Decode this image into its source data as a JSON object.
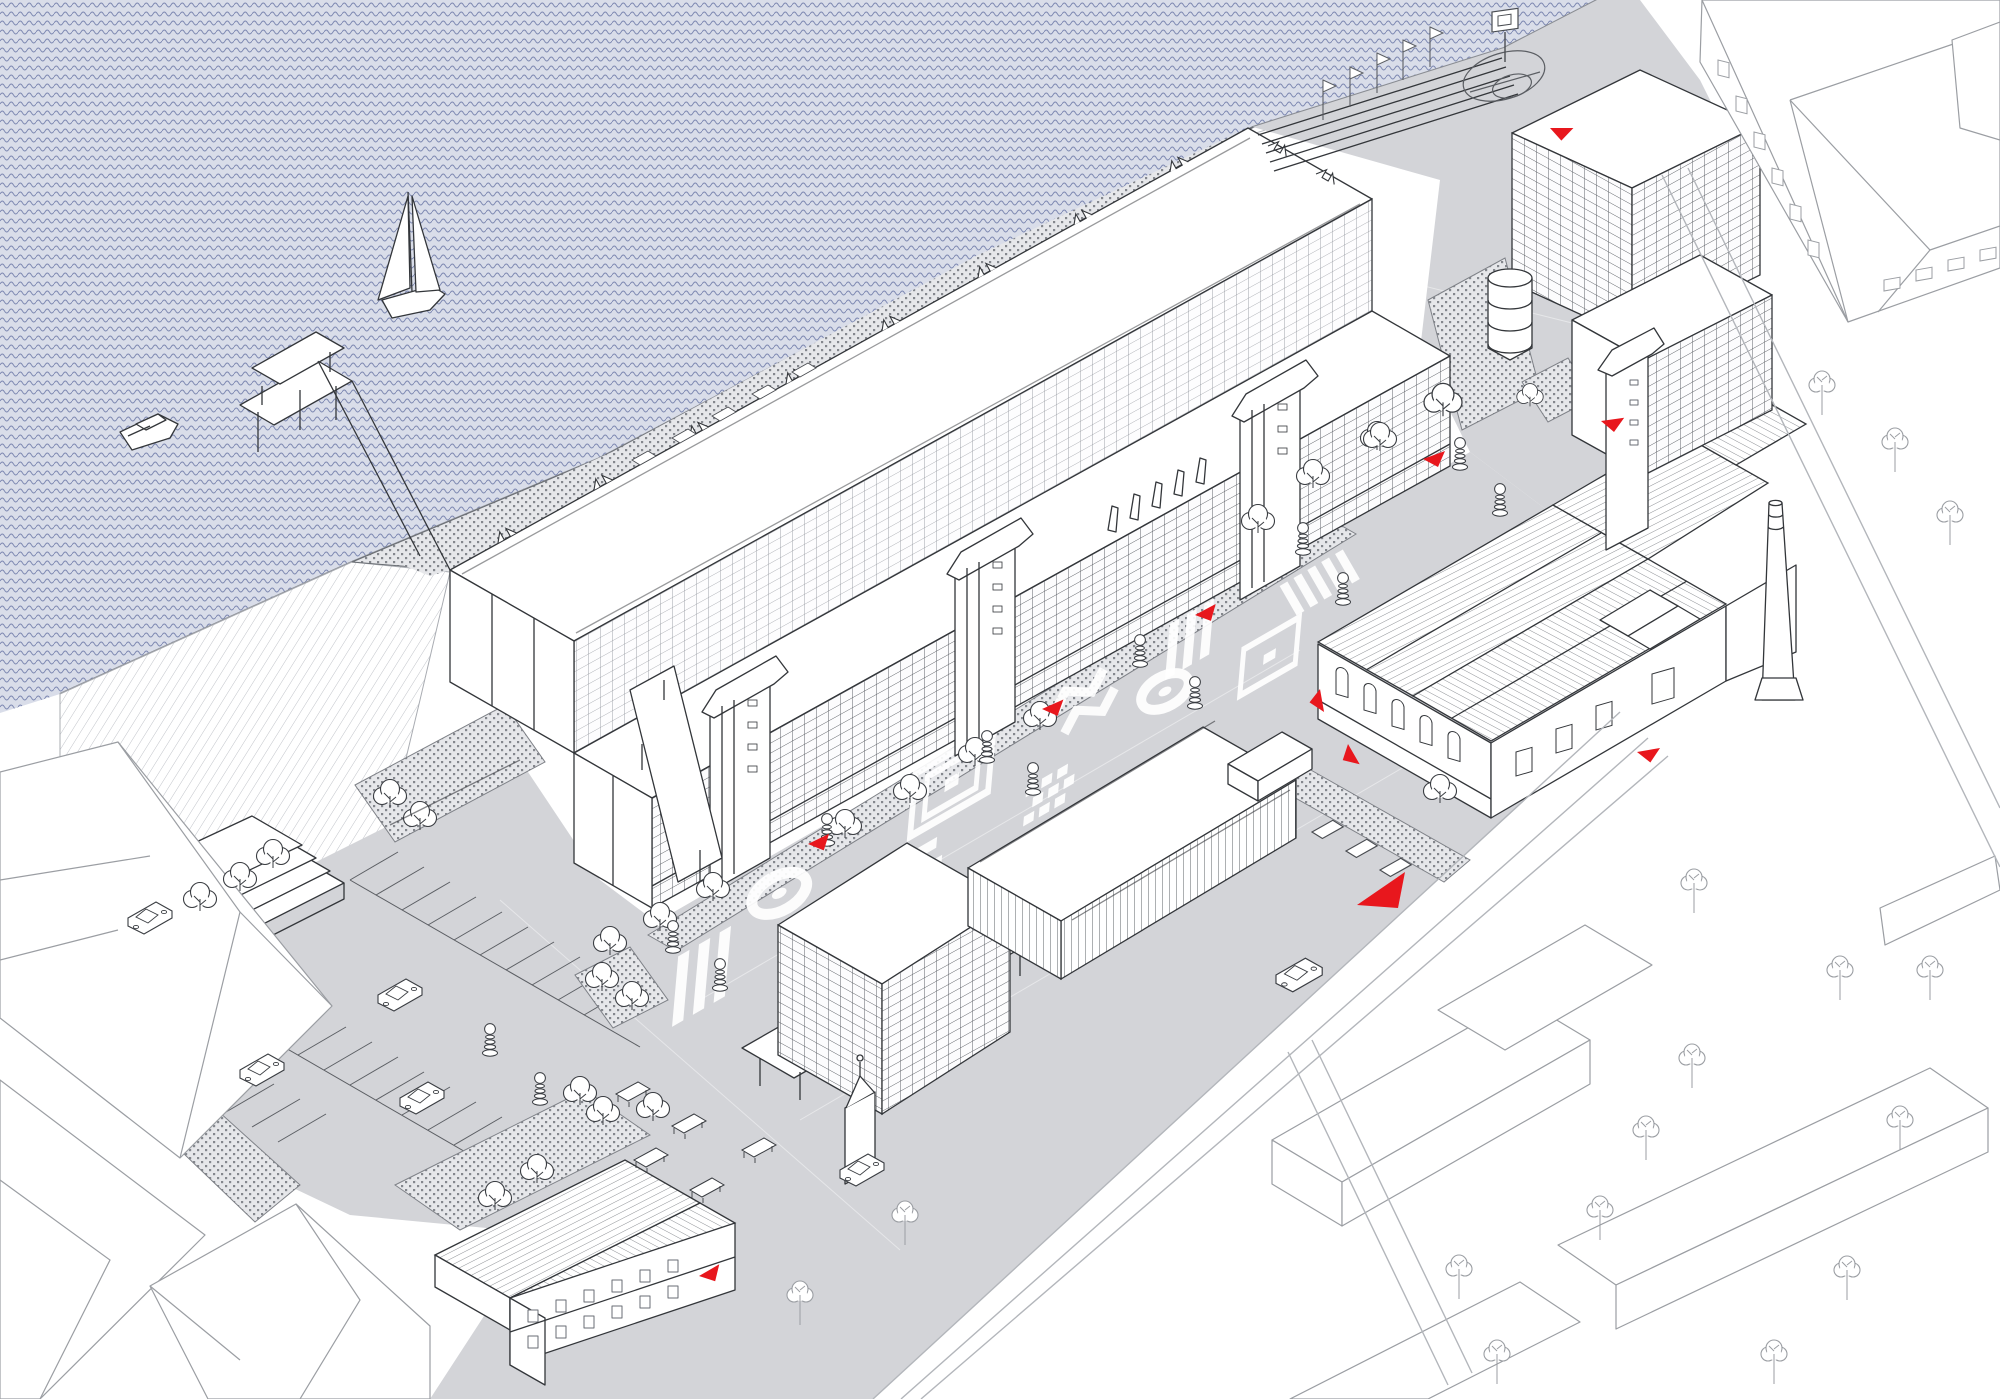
{
  "meta": {
    "title": "Axonometric masterplan drawing of a waterfront factory campus",
    "drawing_type": "architectural site axonometric, line drawing with red accents",
    "image_size": {
      "width": 2000,
      "height": 1399
    }
  },
  "palette": {
    "paper": "#ffffff",
    "water_base": "#d9dde9",
    "water_wave_line": "#7e89b2",
    "plaza_gray": "#d3d4d8",
    "site_line": "#33363a",
    "context_line": "#9b9ea3",
    "paving_dot": "#84878d",
    "roof_hatch": "#8d9095",
    "accent_red": "#e8171d"
  },
  "scene": {
    "water": {
      "label": "Harbour water with wave pattern",
      "boats": [
        {
          "label": "Sailboat with two sails",
          "position": "upper-left water"
        },
        {
          "label": "Small motorboat",
          "position": "left water near shore"
        }
      ]
    },
    "buildings": [
      {
        "id": "main-slab",
        "label": "Main long factory slab with white roof, glazed grid facades and rooftop terrace along the water"
      },
      {
        "id": "mid-rise",
        "label": "Mid-rise office block on columned podium with small spire tower"
      },
      {
        "id": "retail-hall",
        "label": "Low retail hall with clerestory band and rooftop sign box"
      },
      {
        "id": "factory-complex",
        "label": "Historic brick factory with hatched gable roofs, arched windows and tall chimney"
      },
      {
        "id": "northeast-slab",
        "label": "North-east slab building with stair tower wing"
      },
      {
        "id": "south-workshop",
        "label": "Small two-storey workshop with hatched gable roof"
      },
      {
        "id": "context-hip-roof",
        "label": "Context building with hip roof, top right"
      },
      {
        "id": "context-boxes",
        "label": "Context building volumes, right and bottom"
      }
    ],
    "site_elements": {
      "ground_mural_motifs": [
        "diagonal bars",
        "target circles",
        "nested squares",
        "checkerboard diamonds",
        "zigzag stripes",
        "crosswalk bars"
      ],
      "street_lamps": 13,
      "red_markers_small": 10,
      "red_markers_large": 1,
      "site_trees": 26,
      "context_trees": 16,
      "cars": 6,
      "van": 1,
      "quay_benches": 5,
      "picnic_tables": 5,
      "flag_poles": 5,
      "parking_rows": 2,
      "amphitheater_steps": 4,
      "basketball_court": 1,
      "stacked_tank": 1,
      "planting_beds": 7,
      "rooftop_fins": 5,
      "roof_sawtooth_vents": 10
    }
  }
}
